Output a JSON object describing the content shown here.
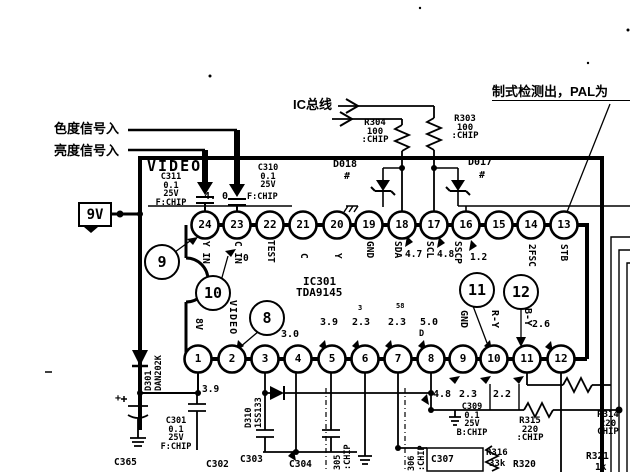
{
  "labels": {
    "chroma_in": "色度信号入",
    "luma_in": "亮度信号入",
    "ic_bus": "IC总线",
    "pal_detect": "制式检测出，PAL为",
    "supply_9v": "9V",
    "video": "VIDEO",
    "ic_ref": "IC301",
    "ic_part": "TDA9145"
  },
  "bubbles": {
    "b9": "9",
    "b10": "10",
    "b8": "8",
    "b11": "11",
    "b12": "12"
  },
  "pins": {
    "top": [
      {
        "n": "24",
        "label": "Y IN",
        "v": ""
      },
      {
        "n": "23",
        "label": "C IN",
        "v": "0"
      },
      {
        "n": "22",
        "label": "TEST",
        "v": ""
      },
      {
        "n": "21",
        "label": "C",
        "v": ""
      },
      {
        "n": "20",
        "label": "Y",
        "v": ""
      },
      {
        "n": "19",
        "label": "GND",
        "v": ""
      },
      {
        "n": "18",
        "label": "SDA",
        "v": "4.7"
      },
      {
        "n": "17",
        "label": "SCL",
        "v": "4.8"
      },
      {
        "n": "16",
        "label": "SSCP",
        "v": "1.2"
      },
      {
        "n": "15",
        "label": "",
        "v": ""
      },
      {
        "n": "14",
        "label": "2FSC",
        "v": ""
      },
      {
        "n": "13",
        "label": "STB",
        "v": ""
      }
    ],
    "bottom": [
      {
        "n": "1",
        "label": "8V",
        "v": "3.9"
      },
      {
        "n": "2",
        "label": "VIDEO",
        "v": ""
      },
      {
        "n": "3",
        "label": "",
        "v": ""
      },
      {
        "n": "4",
        "label": "",
        "v": "3.0"
      },
      {
        "n": "5",
        "label": "",
        "v": "3.9"
      },
      {
        "n": "6",
        "label": "",
        "v": "2.3"
      },
      {
        "n": "7",
        "label": "",
        "v": "2.3"
      },
      {
        "n": "8",
        "label": "",
        "v": "5.0"
      },
      {
        "n": "9",
        "label": "GND",
        "v": ""
      },
      {
        "n": "10",
        "label": "R-Y",
        "v": ""
      },
      {
        "n": "11",
        "label": "B-Y",
        "v": "2.6"
      },
      {
        "n": "12",
        "label": "",
        "v": ""
      }
    ]
  },
  "voltages": {
    "pin24_inline": "4. 0",
    "below_8": "4.8",
    "below_10": "2.3",
    "below_11": "2.2"
  },
  "components": {
    "c311": {
      "name": "C311",
      "value": "0.1",
      "voltage": "25V",
      "type": "F:CHIP"
    },
    "c310": {
      "name": "C310",
      "value": "0.1",
      "voltage": "25V",
      "type": "F:CHIP"
    },
    "r304": {
      "name": "R304",
      "value": "100",
      "type": ":CHIP"
    },
    "r303": {
      "name": "R303",
      "value": "100",
      "type": ":CHIP"
    },
    "d018": {
      "name": "D018",
      "mark": "#"
    },
    "d017": {
      "name": "D017",
      "mark": "#"
    },
    "d301": {
      "name": "D301",
      "part": "DAN202K"
    },
    "d310": {
      "name": "D310",
      "part": "1SS133"
    },
    "c301": {
      "name": "C301",
      "value": "0.1",
      "voltage": "25V",
      "type": "F:CHIP"
    },
    "c365": {
      "name": "C365"
    },
    "c302": {
      "name": "C302"
    },
    "c303": {
      "name": "C303"
    },
    "c304": {
      "name": "C304"
    },
    "c305": {
      "name": "305",
      "type": ":CHIP"
    },
    "c306": {
      "name": "306",
      "type": ":CHIP"
    },
    "c307": {
      "name": "C307"
    },
    "c309": {
      "name": "C309",
      "value": "0.1",
      "voltage": "25V",
      "type": "B:CHIP"
    },
    "r315": {
      "name": "R315",
      "value": "220",
      "type": ":CHIP"
    },
    "r314": {
      "name": "R314",
      "value": "220",
      "type": "CHIP"
    },
    "r316": {
      "name": "R316",
      "value": "33k"
    },
    "r320": {
      "name": "R320"
    },
    "r321": {
      "name": "R321",
      "value": "1k"
    }
  },
  "marks": {
    "d": "D",
    "m3": "3",
    "m58": "58",
    "plus": "+"
  }
}
